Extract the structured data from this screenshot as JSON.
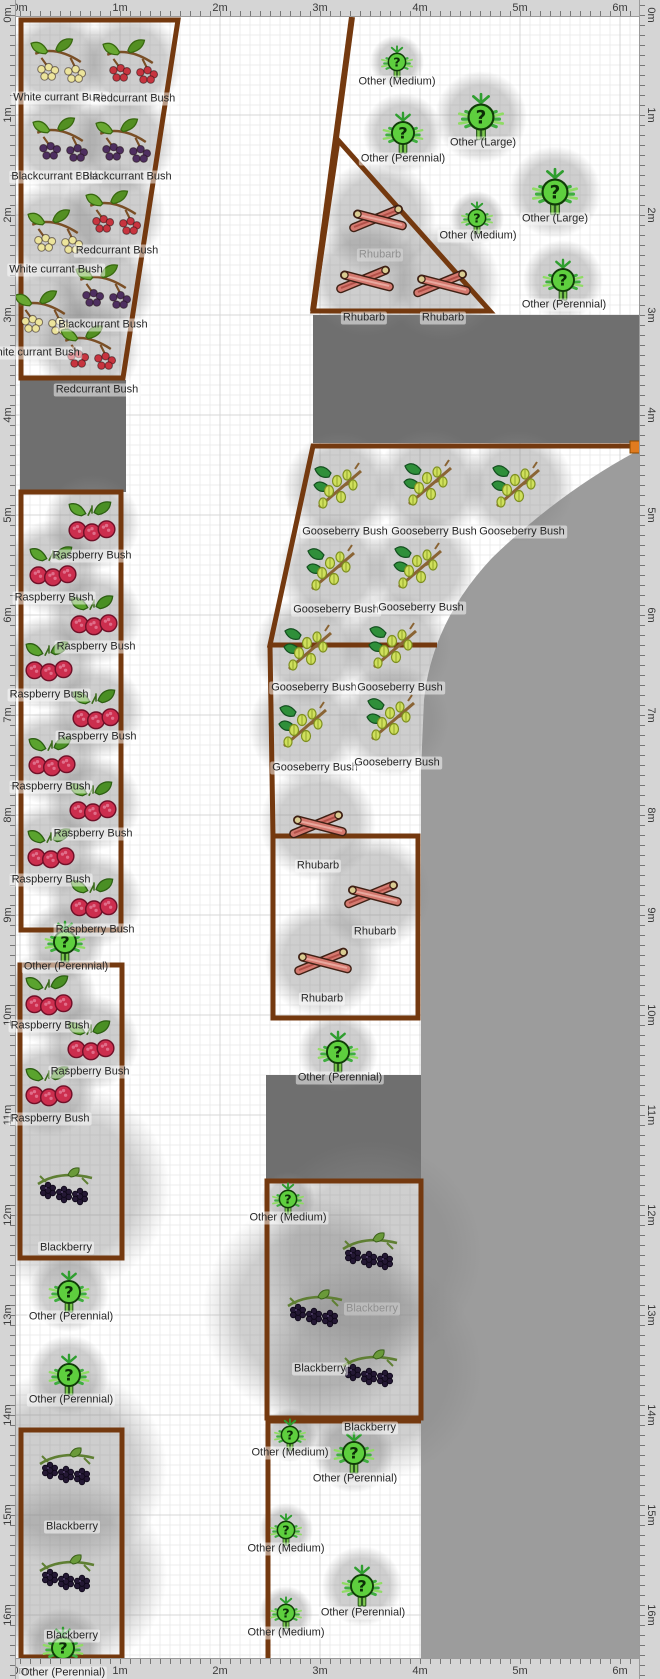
{
  "canvas": {
    "width": 660,
    "height": 1679
  },
  "colors": {
    "bed_outline": "#74390f",
    "zone_dark": "#6f6f6f",
    "zone_light": "#9c9c9c",
    "grid_minor": "#ececec",
    "grid_major": "#d7d7d7",
    "ruler_bg": "#d5d5d5",
    "ruler_text": "#3a3a3a",
    "label_text": "#262626",
    "label_text_muted": "#8f8f8f",
    "handle_orange": "#e07b1f",
    "white_currant": "#ece49c",
    "red_currant": "#c7343f",
    "black_currant": "#4e2f60"
  },
  "rulers": {
    "top_labels": [
      "0m",
      "1m",
      "2m",
      "3m",
      "4m",
      "5m",
      "6m"
    ],
    "bottom_labels": [
      "0m",
      "1m",
      "2m",
      "3m",
      "4m",
      "5m",
      "6m"
    ],
    "left_labels": [
      "0m",
      "1m",
      "2m",
      "3m",
      "4m",
      "5m",
      "6m",
      "7m",
      "8m",
      "9m",
      "10m",
      "11m",
      "12m",
      "13m",
      "14m",
      "15m",
      "16m"
    ],
    "right_labels": [
      "0m",
      "1m",
      "2m",
      "3m",
      "4m",
      "5m",
      "6m",
      "7m",
      "8m",
      "9m",
      "10m",
      "11m",
      "12m",
      "13m",
      "14m",
      "15m",
      "16m"
    ]
  },
  "zones": [
    {
      "name": "path-dark-left",
      "type": "rect",
      "x": 20,
      "y": 380,
      "w": 106,
      "h": 112,
      "shade": "dark"
    },
    {
      "name": "path-dark-top",
      "type": "rect",
      "x": 313,
      "y": 315,
      "w": 326,
      "h": 128,
      "shade": "dark"
    },
    {
      "name": "path-dark-mid",
      "type": "rect",
      "x": 266,
      "y": 1075,
      "w": 156,
      "h": 105,
      "shade": "dark"
    },
    {
      "name": "zone-light-right",
      "type": "path",
      "shade": "light",
      "d": "M639 450 Q560 492 492 558 Q432 622 424 700 L421 770 L421 1658 L639 1658 Z"
    }
  ],
  "beds": [
    {
      "name": "bed-currants",
      "closed": true,
      "pts": [
        [
          21,
          20
        ],
        [
          178,
          20
        ],
        [
          123,
          378
        ],
        [
          21,
          378
        ]
      ]
    },
    {
      "name": "boundary-line",
      "closed": false,
      "w": 6,
      "pts": [
        [
          352,
          17
        ],
        [
          313,
          311
        ]
      ]
    },
    {
      "name": "bed-rhubarb-top",
      "closed": true,
      "pts": [
        [
          338,
          140
        ],
        [
          490,
          311
        ],
        [
          313,
          311
        ]
      ]
    },
    {
      "name": "bed-gooseberry-top",
      "closed": false,
      "pts": [
        [
          639,
          446
        ],
        [
          313,
          446
        ],
        [
          270,
          645
        ],
        [
          437,
          645
        ]
      ]
    },
    {
      "name": "bed-gooseberry-low",
      "closed": false,
      "pts": [
        [
          270,
          645
        ],
        [
          273,
          836
        ]
      ]
    },
    {
      "name": "bed-rhubarb-low",
      "closed": true,
      "pts": [
        [
          273,
          836
        ],
        [
          418,
          836
        ],
        [
          418,
          1018
        ],
        [
          273,
          1018
        ]
      ]
    },
    {
      "name": "bed-raspberry-1",
      "closed": true,
      "pts": [
        [
          21,
          492
        ],
        [
          121,
          492
        ],
        [
          121,
          930
        ],
        [
          21,
          930
        ]
      ]
    },
    {
      "name": "bed-raspberry-2",
      "closed": true,
      "pts": [
        [
          20,
          965
        ],
        [
          122,
          965
        ],
        [
          122,
          1258
        ],
        [
          20,
          1258
        ]
      ]
    },
    {
      "name": "bed-blackberry-left",
      "closed": true,
      "pts": [
        [
          21,
          1430
        ],
        [
          122,
          1430
        ],
        [
          122,
          1657
        ],
        [
          21,
          1657
        ]
      ]
    },
    {
      "name": "bed-blackberry-mid",
      "closed": true,
      "pts": [
        [
          267,
          1181
        ],
        [
          421,
          1181
        ],
        [
          421,
          1418
        ],
        [
          267,
          1418
        ]
      ]
    },
    {
      "name": "bed-bottom-mid",
      "closed": false,
      "pts": [
        [
          421,
          1421
        ],
        [
          268,
          1421
        ],
        [
          268,
          1658
        ]
      ]
    }
  ],
  "handles": [
    {
      "name": "resize-handle",
      "x": 630,
      "y": 441,
      "w": 10,
      "h": 12
    }
  ],
  "plants": [
    {
      "t": "white_currant",
      "l": "White currant Bush",
      "x": 58,
      "y": 62,
      "lx": 60,
      "ly": 98
    },
    {
      "t": "red_currant",
      "l": "Redcurrant Bush",
      "x": 130,
      "y": 63,
      "lx": 134,
      "ly": 99
    },
    {
      "t": "black_currant",
      "l": "Blackcurrant Bush",
      "x": 60,
      "y": 141,
      "lx": 56,
      "ly": 177
    },
    {
      "t": "black_currant",
      "l": "Blackcurrant Bush",
      "x": 123,
      "y": 142,
      "lx": 127,
      "ly": 177
    },
    {
      "t": "red_currant",
      "l": "Redcurrant Bush",
      "x": 113,
      "y": 214,
      "lx": 117,
      "ly": 251
    },
    {
      "t": "white_currant",
      "l": "White currant Bush",
      "x": 55,
      "y": 233,
      "lx": 56,
      "ly": 270
    },
    {
      "t": "black_currant",
      "l": "Blackcurrant Bush",
      "x": 103,
      "y": 288,
      "lx": 103,
      "ly": 325
    },
    {
      "t": "white_currant",
      "l": "White currant Bush",
      "x": 42,
      "y": 314,
      "lx": 33,
      "ly": 353
    },
    {
      "t": "red_currant",
      "l": "Redcurrant Bush",
      "x": 88,
      "y": 349,
      "lx": 97,
      "ly": 390
    },
    {
      "t": "other_medium",
      "l": "Other (Medium)",
      "x": 397,
      "y": 62,
      "lx": 397,
      "ly": 82
    },
    {
      "t": "other_large",
      "l": "Other (Large)",
      "x": 481,
      "y": 117,
      "lx": 483,
      "ly": 143
    },
    {
      "t": "other_perennial",
      "l": "Other (Perennial)",
      "x": 403,
      "y": 133,
      "lx": 403,
      "ly": 159
    },
    {
      "t": "other_large",
      "l": "Other (Large)",
      "x": 555,
      "y": 192,
      "lx": 555,
      "ly": 219
    },
    {
      "t": "other_medium",
      "l": "Other (Medium)",
      "x": 477,
      "y": 218,
      "lx": 478,
      "ly": 236
    },
    {
      "t": "other_perennial",
      "l": "Other (Perennial)",
      "x": 563,
      "y": 280,
      "lx": 564,
      "ly": 305
    },
    {
      "t": "rhubarb",
      "l": "Rhubarb",
      "x": 378,
      "y": 217,
      "lx": 380,
      "ly": 255,
      "m": true
    },
    {
      "t": "rhubarb",
      "l": "Rhubarb",
      "x": 365,
      "y": 278,
      "lx": 364,
      "ly": 318
    },
    {
      "t": "rhubarb",
      "l": "Rhubarb",
      "x": 442,
      "y": 282,
      "lx": 443,
      "ly": 318
    },
    {
      "t": "gooseberry",
      "l": "Gooseberry Bush",
      "x": 340,
      "y": 488,
      "lx": 345,
      "ly": 532
    },
    {
      "t": "gooseberry",
      "l": "Gooseberry Bush",
      "x": 430,
      "y": 485,
      "lx": 434,
      "ly": 532
    },
    {
      "t": "gooseberry",
      "l": "Gooseberry Bush",
      "x": 518,
      "y": 487,
      "lx": 522,
      "ly": 532
    },
    {
      "t": "gooseberry",
      "l": "Gooseberry Bush",
      "x": 333,
      "y": 570,
      "lx": 336,
      "ly": 610
    },
    {
      "t": "gooseberry",
      "l": "Gooseberry Bush",
      "x": 420,
      "y": 568,
      "lx": 421,
      "ly": 608
    },
    {
      "t": "gooseberry",
      "l": "Gooseberry Bush",
      "x": 310,
      "y": 650,
      "lx": 314,
      "ly": 688
    },
    {
      "t": "gooseberry",
      "l": "Gooseberry Bush",
      "x": 395,
      "y": 648,
      "lx": 400,
      "ly": 688
    },
    {
      "t": "gooseberry",
      "l": "Gooseberry Bush",
      "x": 305,
      "y": 727,
      "lx": 315,
      "ly": 768
    },
    {
      "t": "gooseberry",
      "l": "Gooseberry Bush",
      "x": 393,
      "y": 720,
      "lx": 397,
      "ly": 763
    },
    {
      "t": "rhubarb",
      "l": "Rhubarb",
      "x": 318,
      "y": 823,
      "lx": 318,
      "ly": 866
    },
    {
      "t": "rhubarb",
      "l": "Rhubarb",
      "x": 373,
      "y": 893,
      "lx": 375,
      "ly": 932
    },
    {
      "t": "rhubarb",
      "l": "Rhubarb",
      "x": 323,
      "y": 960,
      "lx": 322,
      "ly": 999
    },
    {
      "t": "other_perennial",
      "l": "Other (Perennial)",
      "x": 338,
      "y": 1052,
      "lx": 340,
      "ly": 1078
    },
    {
      "t": "raspberry",
      "l": "Raspberry Bush",
      "x": 92,
      "y": 523,
      "lx": 92,
      "ly": 556
    },
    {
      "t": "raspberry",
      "l": "Raspberry Bush",
      "x": 53,
      "y": 568,
      "lx": 54,
      "ly": 598
    },
    {
      "t": "raspberry",
      "l": "Raspberry Bush",
      "x": 94,
      "y": 617,
      "lx": 96,
      "ly": 647
    },
    {
      "t": "raspberry",
      "l": "Raspberry Bush",
      "x": 49,
      "y": 663,
      "lx": 49,
      "ly": 695
    },
    {
      "t": "raspberry",
      "l": "Raspberry Bush",
      "x": 96,
      "y": 711,
      "lx": 97,
      "ly": 737
    },
    {
      "t": "raspberry",
      "l": "Raspberry Bush",
      "x": 52,
      "y": 758,
      "lx": 51,
      "ly": 787
    },
    {
      "t": "raspberry",
      "l": "Raspberry Bush",
      "x": 93,
      "y": 803,
      "lx": 93,
      "ly": 834
    },
    {
      "t": "raspberry",
      "l": "Raspberry Bush",
      "x": 51,
      "y": 850,
      "lx": 51,
      "ly": 880
    },
    {
      "t": "raspberry",
      "l": "Raspberry Bush",
      "x": 94,
      "y": 900,
      "lx": 95,
      "ly": 930
    },
    {
      "t": "other_perennial",
      "l": "Other (Perennial)",
      "x": 65,
      "y": 942,
      "lx": 66,
      "ly": 967
    },
    {
      "t": "raspberry",
      "l": "Raspberry Bush",
      "x": 49,
      "y": 997,
      "lx": 50,
      "ly": 1026
    },
    {
      "t": "raspberry",
      "l": "Raspberry Bush",
      "x": 91,
      "y": 1042,
      "lx": 90,
      "ly": 1072
    },
    {
      "t": "raspberry",
      "l": "Raspberry Bush",
      "x": 49,
      "y": 1088,
      "lx": 50,
      "ly": 1119
    },
    {
      "t": "blackberry",
      "l": "Blackberry",
      "x": 65,
      "y": 1188,
      "lx": 66,
      "ly": 1248,
      "s": 105
    },
    {
      "t": "other_perennial",
      "l": "Other (Perennial)",
      "x": 69,
      "y": 1292,
      "lx": 71,
      "ly": 1317
    },
    {
      "t": "other_perennial",
      "l": "Other (Perennial)",
      "x": 69,
      "y": 1375,
      "lx": 71,
      "ly": 1400
    },
    {
      "t": "blackberry",
      "l": "Blackberry",
      "x": 67,
      "y": 1468,
      "lx": 72,
      "ly": 1527,
      "s": 100
    },
    {
      "t": "blackberry",
      "l": "Blackberry",
      "x": 67,
      "y": 1575,
      "lx": 72,
      "ly": 1636,
      "s": 100
    },
    {
      "t": "other_perennial",
      "l": "Other (Perennial)",
      "x": 63,
      "y": 1648,
      "lx": 63,
      "ly": 1673
    },
    {
      "t": "other_medium",
      "l": "Other (Medium)",
      "x": 288,
      "y": 1199,
      "lx": 288,
      "ly": 1218
    },
    {
      "t": "blackberry",
      "l": "Blackberry",
      "x": 370,
      "y": 1253,
      "lx": 372,
      "ly": 1309,
      "s": 112,
      "m": true
    },
    {
      "t": "blackberry",
      "l": "Blackberry",
      "x": 315,
      "y": 1310,
      "lx": 320,
      "ly": 1369,
      "s": 112
    },
    {
      "t": "blackberry",
      "l": "Blackberry",
      "x": 370,
      "y": 1370,
      "lx": 370,
      "ly": 1428,
      "s": 112
    },
    {
      "t": "other_medium",
      "l": "Other (Medium)",
      "x": 290,
      "y": 1435,
      "lx": 290,
      "ly": 1453
    },
    {
      "t": "other_perennial",
      "l": "Other (Perennial)",
      "x": 354,
      "y": 1453,
      "lx": 355,
      "ly": 1479
    },
    {
      "t": "other_medium",
      "l": "Other (Medium)",
      "x": 286,
      "y": 1530,
      "lx": 286,
      "ly": 1549
    },
    {
      "t": "other_perennial",
      "l": "Other (Perennial)",
      "x": 362,
      "y": 1586,
      "lx": 363,
      "ly": 1613
    },
    {
      "t": "other_medium",
      "l": "Other (Medium)",
      "x": 286,
      "y": 1613,
      "lx": 286,
      "ly": 1633
    }
  ]
}
